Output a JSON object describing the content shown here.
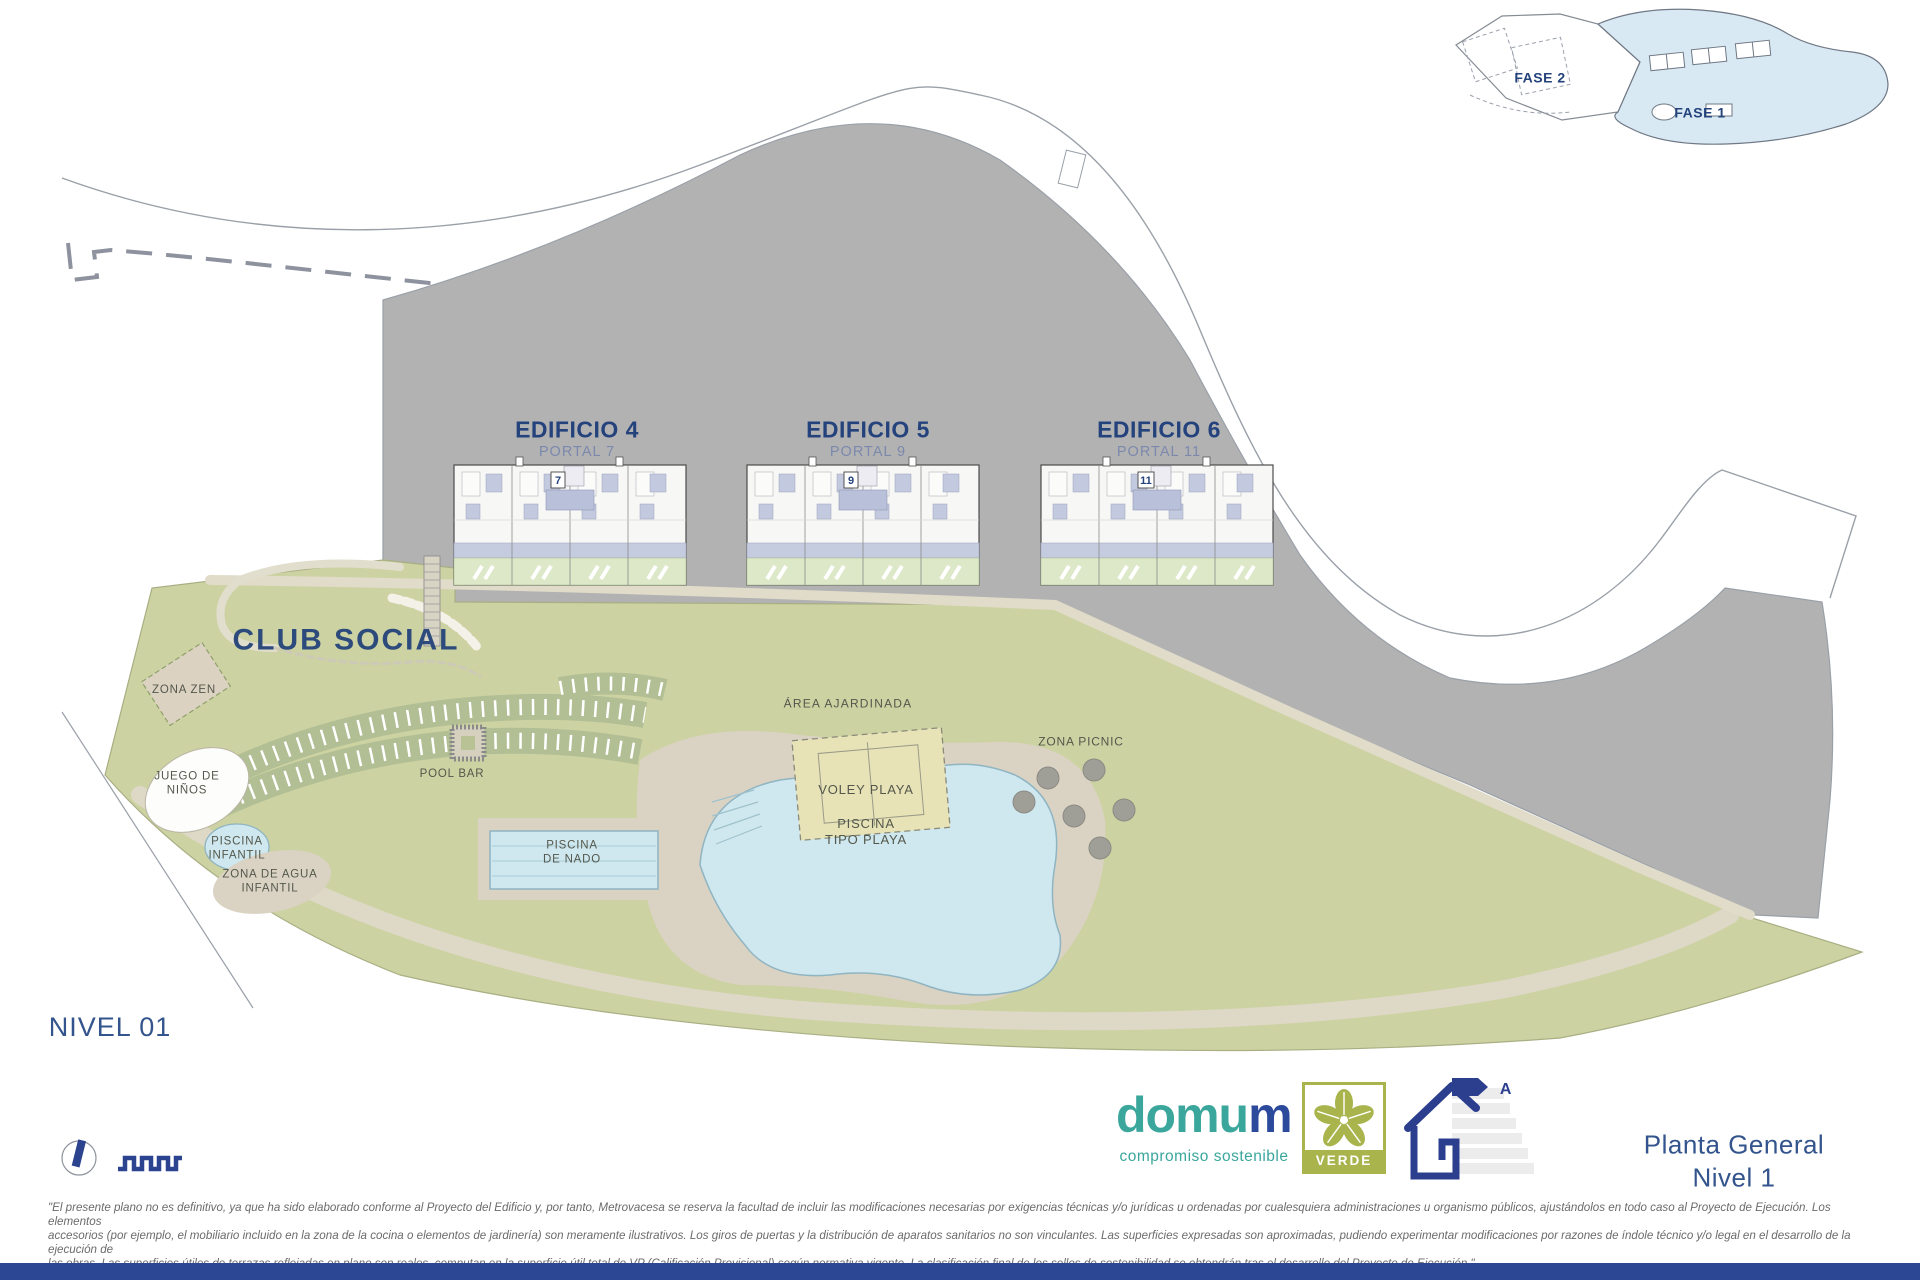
{
  "inset": {
    "fase1": "FASE 1",
    "fase2": "FASE 2"
  },
  "buildings": [
    {
      "name": "EDIFICIO 4",
      "portal": "PORTAL 7",
      "number": "7"
    },
    {
      "name": "EDIFICIO 5",
      "portal": "PORTAL 9",
      "number": "9"
    },
    {
      "name": "EDIFICIO 6",
      "portal": "PORTAL 11",
      "number": "11"
    }
  ],
  "zones": {
    "club_social": "CLUB SOCIAL",
    "zona_zen": "ZONA ZEN",
    "juego_de_ninos": "JUEGO DE\nNIÑOS",
    "piscina_infantil": "PISCINA\nINFANTIL",
    "piscina_tipo_playa": "PISCINA\nTIPO PLAYA",
    "zona_agua_infantil": "ZONA DE AGUA\nINFANTIL",
    "pool_bar": "POOL BAR",
    "piscina_de_nado": "PISCINA\nDE NADO",
    "area_ajardinada": "ÁREA AJARDINADA",
    "voley_playa": "VOLEY PLAYA",
    "zona_picnic": "ZONA PICNIC"
  },
  "level_label": "NIVEL 01",
  "sheet_title": "Planta General Nivel 1",
  "logo": {
    "brand_primary": "domu",
    "brand_accent": "m",
    "tagline": "compromiso sostenible",
    "badge": "VERDE",
    "energy_letter": "A"
  },
  "disclaimer": {
    "line1": "\"El presente plano no es definitivo, ya que ha sido elaborado conforme al Proyecto del Edificio y, por tanto, Metrovacesa se reserva la facultad de incluir las modificaciones necesarias por exigencias técnicas y/o jurídicas u ordenadas por cualesquiera administraciones u organismo públicos, ajustándolos en todo caso al Proyecto de Ejecución. Los elementos",
    "line2": "accesorios (por ejemplo, el mobiliario incluido en la zona de la cocina o elementos de jardinería) son meramente ilustrativos. Los giros de puertas y la distribución de aparatos sanitarios no son vinculantes. Las superficies expresadas son aproximadas, pudiendo experimentar modificaciones por razones de índole técnico y/o legal en el desarrollo de la ejecución de",
    "line3": "las obras. Las superficies útiles de terrazas reflejadas en plano son reales, computan en la superficie útil total de VP (Calificación Provisional) según normativa vigente. La clasificación final de los sellos de sostenibilidad se obtendrán tras el desarrollo del Proyecto de Ejecución.\""
  },
  "colors": {
    "hill_gray": "#b2b2b2",
    "site_green": "#cdd2a2",
    "path_tan": "#ddd9c6",
    "sand": "#dad3c3",
    "pool_blue": "#cfe7ee",
    "terrace_lavender": "#c6cce0",
    "garden_green": "#dce8c8",
    "accent_navy": "#24427c",
    "brand_teal": "#3aa69c",
    "brand_navy": "#2c4a9c",
    "verde_olive": "#a9b44c",
    "fase1_blue": "#d9e9f4",
    "bottom_bar": "#2c4894"
  }
}
